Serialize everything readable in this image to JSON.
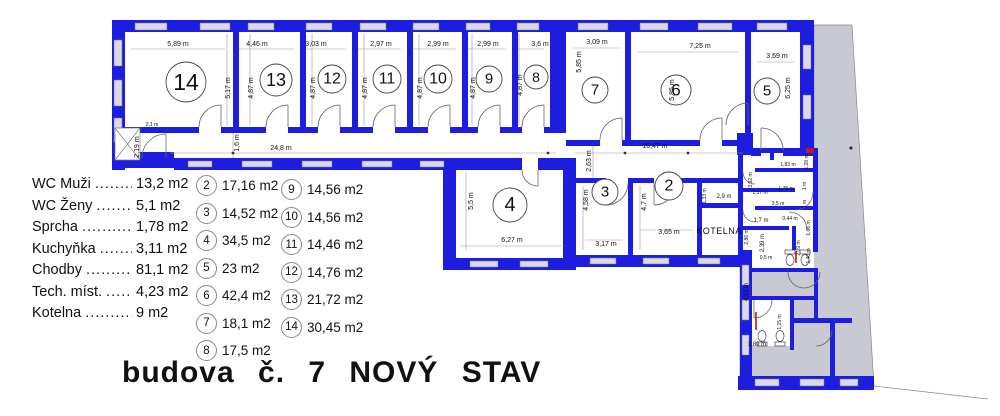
{
  "title": "budova  č. 7   NOVÝ  STAV",
  "legend": {
    "rows": [
      {
        "label": "WC Muži",
        "leader": "...........",
        "value": "13,2 m2"
      },
      {
        "label": "WC Ženy",
        "leader": "...........",
        "value": "5,1 m2"
      },
      {
        "label": "Sprcha",
        "leader": "...........",
        "value": "1,78 m2"
      },
      {
        "label": "Kuchyňka",
        "leader": ".........",
        "value": "3,11 m2"
      },
      {
        "label": "Chodby",
        "leader": "..........",
        "value": "81,1 m2"
      },
      {
        "label": "Tech. míst.",
        "leader": "........",
        "value": "4,23 m2"
      },
      {
        "label": "Kotelna",
        "leader": "..........",
        "value": "9 m2"
      }
    ]
  },
  "areas": {
    "col1": [
      {
        "num": "2",
        "value": "17,16 m2"
      },
      {
        "num": "3",
        "value": "14,52 m2"
      },
      {
        "num": "4",
        "value": "34,5 m2"
      },
      {
        "num": "5",
        "value": "23 m2"
      },
      {
        "num": "6",
        "value": "42,4 m2"
      },
      {
        "num": "7",
        "value": "18,1 m2"
      },
      {
        "num": "8",
        "value": "17,5 m2"
      }
    ],
    "col2": [
      {
        "num": "9",
        "value": "14,56 m2"
      },
      {
        "num": "10",
        "value": "14,56 m2"
      },
      {
        "num": "11",
        "value": "14,46 m2"
      },
      {
        "num": "12",
        "value": "14,76 m2"
      },
      {
        "num": "13",
        "value": "21,72 m2"
      },
      {
        "num": "14",
        "value": "30,45 m2"
      }
    ]
  },
  "plan": {
    "kotelna_label": "KOTELNA",
    "colors": {
      "wall": "#1d1de0",
      "adjacent_grey": "#c9c9d4",
      "accent_red": "#cc1111",
      "window": "#d9d9e8"
    },
    "rooms": [
      {
        "n": "14",
        "x": 186,
        "y": 82,
        "r": 20
      },
      {
        "n": "13",
        "x": 276,
        "y": 80,
        "r": 16
      },
      {
        "n": "12",
        "x": 332,
        "y": 79,
        "r": 14
      },
      {
        "n": "11",
        "x": 387,
        "y": 79,
        "r": 14
      },
      {
        "n": "10",
        "x": 438,
        "y": 79,
        "r": 14
      },
      {
        "n": "9",
        "x": 489,
        "y": 79,
        "r": 13
      },
      {
        "n": "8",
        "x": 536,
        "y": 77,
        "r": 12
      },
      {
        "n": "7",
        "x": 595,
        "y": 90,
        "r": 13
      },
      {
        "n": "6",
        "x": 676,
        "y": 90,
        "r": 15
      },
      {
        "n": "5",
        "x": 767,
        "y": 91,
        "r": 13
      },
      {
        "n": "4",
        "x": 510,
        "y": 205,
        "r": 17
      },
      {
        "n": "3",
        "x": 605,
        "y": 192,
        "r": 13
      },
      {
        "n": "2",
        "x": 669,
        "y": 186,
        "r": 14
      }
    ],
    "dims": [
      {
        "t": "5,89 m",
        "x": 178,
        "y": 46
      },
      {
        "t": "4,46 m",
        "x": 257,
        "y": 46
      },
      {
        "t": "3,03 m",
        "x": 316,
        "y": 46
      },
      {
        "t": "2,97 m",
        "x": 381,
        "y": 46
      },
      {
        "t": "2,99 m",
        "x": 438,
        "y": 46
      },
      {
        "t": "2,99 m",
        "x": 488,
        "y": 46
      },
      {
        "t": "3,6 m",
        "x": 540,
        "y": 46
      },
      {
        "t": "3,09 m",
        "x": 597,
        "y": 44
      },
      {
        "t": "7,25 m",
        "x": 700,
        "y": 48
      },
      {
        "t": "3,69 m",
        "x": 777,
        "y": 58
      },
      {
        "t": "5,17 m",
        "x": 230,
        "y": 88,
        "rot": 1
      },
      {
        "t": "4,87 m",
        "x": 253,
        "y": 88,
        "rot": 1
      },
      {
        "t": "4,87 m",
        "x": 315,
        "y": 88,
        "rot": 1
      },
      {
        "t": "4,87 m",
        "x": 367,
        "y": 88,
        "rot": 1
      },
      {
        "t": "4,87 m",
        "x": 422,
        "y": 88,
        "rot": 1
      },
      {
        "t": "4,87 m",
        "x": 475,
        "y": 88,
        "rot": 1
      },
      {
        "t": "4,87 m",
        "x": 522,
        "y": 85,
        "rot": 1
      },
      {
        "t": "5,85 m",
        "x": 581,
        "y": 62,
        "rot": 1
      },
      {
        "t": "5,85 m",
        "x": 674,
        "y": 90,
        "rot": 1
      },
      {
        "t": "6,25 m",
        "x": 790,
        "y": 88,
        "rot": 1
      },
      {
        "t": "2,1 m",
        "x": 152,
        "y": 126,
        "s": 5
      },
      {
        "t": "2,19 m",
        "x": 139,
        "y": 147,
        "rot": 1
      },
      {
        "t": "1,6 m",
        "x": 239,
        "y": 143,
        "rot": 1
      },
      {
        "t": "24,8 m",
        "x": 281,
        "y": 150
      },
      {
        "t": "10,47 m",
        "x": 655,
        "y": 148
      },
      {
        "t": "2,63 m",
        "x": 591,
        "y": 161,
        "rot": 1
      },
      {
        "t": "5,5 m",
        "x": 473,
        "y": 201,
        "rot": 1
      },
      {
        "t": "6,27 m",
        "x": 512,
        "y": 242
      },
      {
        "t": "4,58 m",
        "x": 588,
        "y": 200,
        "rot": 1
      },
      {
        "t": "3,17 m",
        "x": 606,
        "y": 246
      },
      {
        "t": "4,7 m",
        "x": 646,
        "y": 202,
        "rot": 1
      },
      {
        "t": "3,65 m",
        "x": 669,
        "y": 234
      },
      {
        "t": "1,33 m",
        "x": 706,
        "y": 196,
        "rot": 1,
        "s": 5
      },
      {
        "t": "2,9 m",
        "x": 724,
        "y": 198,
        "s": 6
      },
      {
        "t": "3,92 m",
        "x": 752,
        "y": 180,
        "rot": 1,
        "s": 5
      },
      {
        "t": "1,83 m",
        "x": 788,
        "y": 166,
        "s": 5
      },
      {
        "t": "1,28 m",
        "x": 808,
        "y": 162,
        "rot": 1,
        "s": 5
      },
      {
        "t": "1,78 m",
        "x": 786,
        "y": 190,
        "s": 5
      },
      {
        "t": "1 m",
        "x": 806,
        "y": 186,
        "rot": 1,
        "s": 5
      },
      {
        "t": "1,57 m",
        "x": 760,
        "y": 194,
        "s": 5
      },
      {
        "t": "3,5 m",
        "x": 778,
        "y": 205,
        "s": 5
      },
      {
        "t": "1 m",
        "x": 806,
        "y": 204,
        "rot": 1,
        "s": 5
      },
      {
        "t": "1,7 m",
        "x": 761,
        "y": 222,
        "s": 6
      },
      {
        "t": "0,44 m",
        "x": 790,
        "y": 220,
        "s": 5
      },
      {
        "t": "1,06 m",
        "x": 810,
        "y": 228,
        "rot": 1,
        "s": 5
      },
      {
        "t": "2,86 m",
        "x": 748,
        "y": 237,
        "rot": 1,
        "s": 5
      },
      {
        "t": "2,39 m",
        "x": 764,
        "y": 243,
        "rot": 1,
        "s": 6
      },
      {
        "t": "0,5 m",
        "x": 766,
        "y": 259,
        "s": 5
      },
      {
        "t": "2,09 m",
        "x": 800,
        "y": 248,
        "rot": 1,
        "s": 5
      },
      {
        "t": "1,40 m",
        "x": 810,
        "y": 256,
        "rot": 1,
        "s": 5
      },
      {
        "t": "4,12 m",
        "x": 748,
        "y": 292,
        "rot": 1,
        "s": 6
      },
      {
        "t": "1,15 m",
        "x": 781,
        "y": 322,
        "rot": 1,
        "s": 5
      },
      {
        "t": "1,89 m",
        "x": 757,
        "y": 346,
        "s": 6
      }
    ]
  }
}
